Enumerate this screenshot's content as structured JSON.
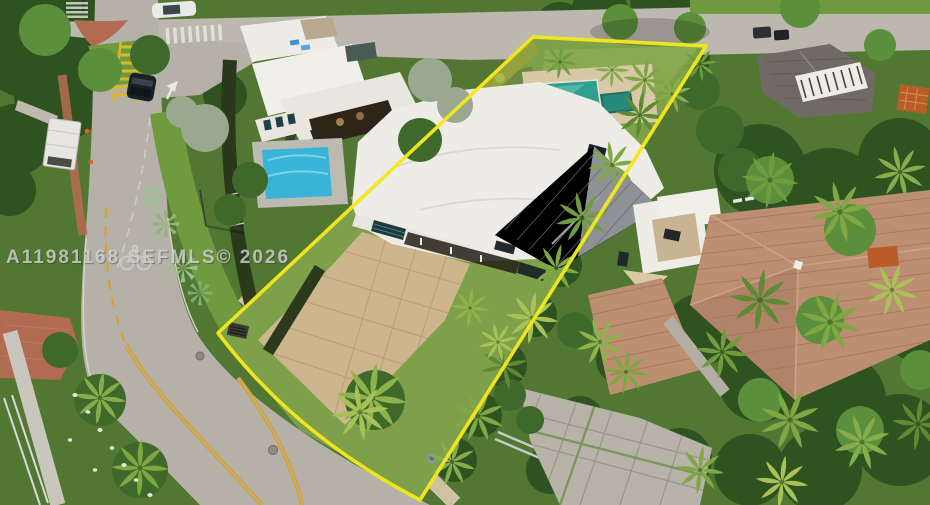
{
  "watermark": {
    "text": "A11981168  SEFMLS© 2026",
    "icon": "bicycle-icon"
  },
  "colors": {
    "boundary_yellow": "#f3e71e",
    "road_gray": "#b5b1a8",
    "top_road_gray": "#bcb8af",
    "red_brick": "#b06b50",
    "lawn_green": "#7fa04a",
    "subject_pool_teal": "#2f9f90",
    "left_pool_cyan": "#3ab3d8",
    "right_pool_navy": "#1d4f96",
    "white_roof": "#eeece7",
    "gray_metal_roof": "#85888e",
    "terracotta_roof": "#bc8e72",
    "driveway_tan": "#cdb58d",
    "double_yellow": "#d8a227",
    "watermark_gray": "#cfcfcf"
  }
}
